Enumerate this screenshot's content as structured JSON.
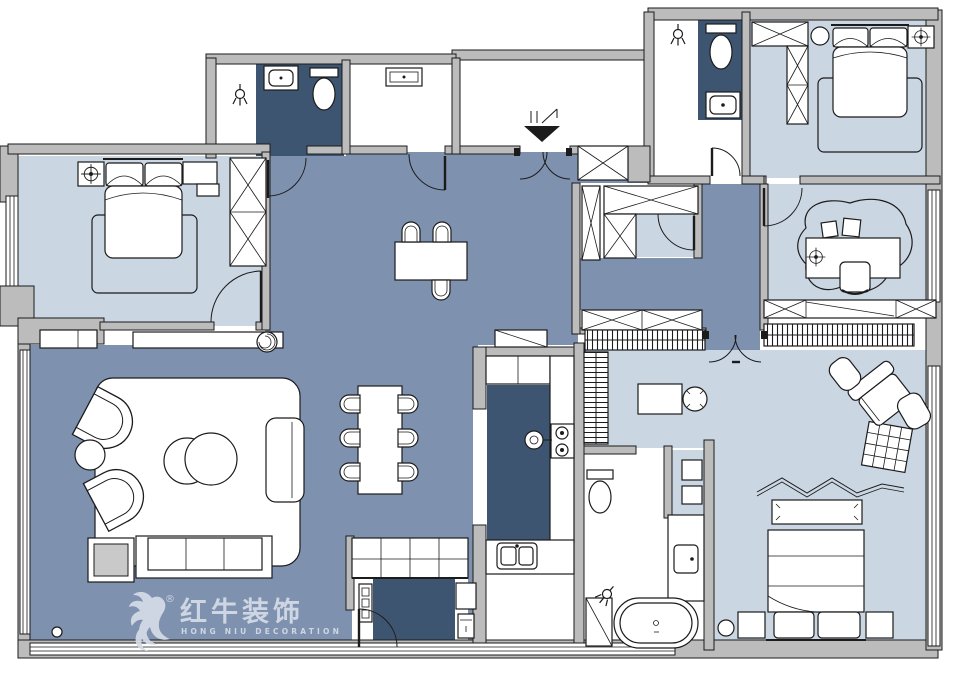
{
  "watermark": {
    "logo_icon": "bull-logo-icon",
    "registered": "®",
    "brand": "红牛装饰",
    "subtitle": "HONG NIU DECORATION"
  },
  "colors": {
    "floor_main": "#7E91AE",
    "floor_room": "#CBD6E3",
    "floor_wet": "#3E5571",
    "wall_fill": "#BCBCBC",
    "line": "#1B1B1B",
    "table_gray": "#C9C9C9",
    "watermark": "#D5DCE8"
  },
  "rooms": [
    {
      "name": "living-room",
      "floor": "main"
    },
    {
      "name": "dining-area",
      "floor": "main"
    },
    {
      "name": "entry-hall",
      "floor": "main"
    },
    {
      "name": "corridor",
      "floor": "main"
    },
    {
      "name": "master-bedroom",
      "floor": "room"
    },
    {
      "name": "bedroom-2",
      "floor": "room"
    },
    {
      "name": "bedroom-3",
      "floor": "room"
    },
    {
      "name": "study",
      "floor": "room"
    },
    {
      "name": "family-area",
      "floor": "room"
    },
    {
      "name": "walk-in-closet",
      "floor": "room"
    },
    {
      "name": "bathroom-1",
      "floor": "wet"
    },
    {
      "name": "bathroom-2",
      "floor": "wet"
    },
    {
      "name": "bathroom-3",
      "floor": "white"
    },
    {
      "name": "kitchen",
      "floor": "wet"
    },
    {
      "name": "laundry",
      "floor": "wet"
    },
    {
      "name": "entry-vestibule",
      "floor": "white"
    }
  ]
}
